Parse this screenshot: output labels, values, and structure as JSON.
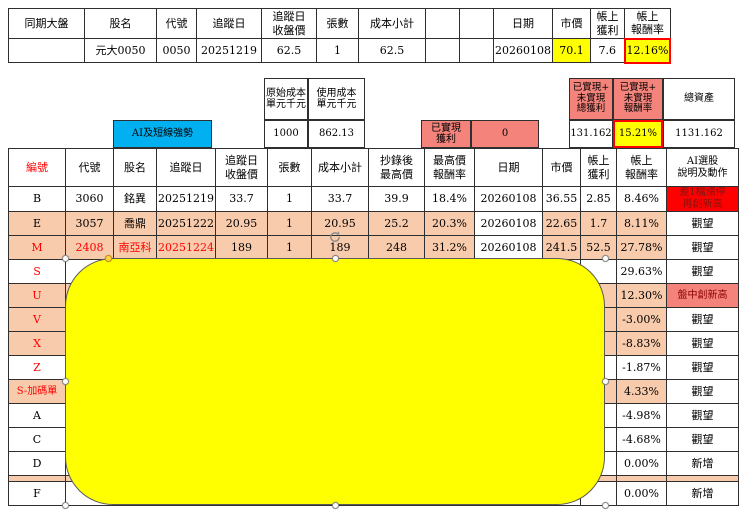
{
  "colors": {
    "yellow": "#FFFF00",
    "salmon": "#F4837C",
    "peach": "#F8CBAD",
    "blue": "#00B0F0",
    "red": "#FF0000",
    "red_cell_text": "#7C1712",
    "salmon_cell_text": "#8B0000",
    "highlight_border": "#FF0000"
  },
  "top_table": {
    "headers": [
      "同期大盤",
      "股名",
      "代號",
      "追蹤日",
      "追蹤日\n收盤價",
      "張數",
      "成本小計",
      "",
      "",
      "日期",
      "市價",
      "帳上\n獲利",
      "帳上\n報酬率"
    ],
    "values": [
      "",
      "元大0050",
      "0050",
      "20251219",
      "62.5",
      "1",
      "62.5",
      "",
      "",
      "20260108",
      "70.1",
      "7.6",
      "12.16%"
    ]
  },
  "summary": {
    "ai_tag": "AI及短線強勢",
    "original_cost_label": "原始成本\n單元千元",
    "original_cost": "1000",
    "used_cost_label": "使用成本\n單元千元",
    "used_cost": "862.13",
    "realized_label": "已實現\n獲利",
    "realized_value": "0",
    "total_profit_label": "已實現+\n未實現\n總獲利",
    "total_profit": "131.162",
    "total_return_label": "已實現+\n未實現\n報酬率",
    "total_return": "15.21%",
    "total_assets_label": "總資產",
    "total_assets": "1131.162"
  },
  "main_table": {
    "headers": [
      "編號",
      "代號",
      "股名",
      "追蹤日",
      "追蹤日\n收盤價",
      "張數",
      "成本小計",
      "抄錄後\n最高價",
      "最高價\n報酬率",
      "日期",
      "市價",
      "帳上\n獲利",
      "帳上\n報酬率",
      "AI選股\n說明及動作"
    ],
    "rows": [
      {
        "id": "B",
        "code": "3060",
        "name": "銘異",
        "track_date": "20251219",
        "track_close": "33.7",
        "lots": "1",
        "cost": "33.7",
        "high": "39.9",
        "high_return": "18.4%",
        "date": "20260108",
        "price": "36.55",
        "profit": "2.85",
        "return_pct": "8.46%",
        "action": "差1檔漲停\n再創新高",
        "bg": "white",
        "id_red": false,
        "label_red": false,
        "action_bg": "red"
      },
      {
        "id": "E",
        "code": "3057",
        "name": "喬鼎",
        "track_date": "20251222",
        "track_close": "20.95",
        "lots": "1",
        "cost": "20.95",
        "high": "25.2",
        "high_return": "20.3%",
        "date": "20260108",
        "price": "22.65",
        "profit": "1.7",
        "return_pct": "8.11%",
        "action": "觀望",
        "bg": "peach",
        "id_red": false,
        "label_red": false,
        "action_bg": "white"
      },
      {
        "id": "M",
        "code": "2408",
        "name": "南亞科",
        "track_date": "20251224",
        "track_close": "189",
        "lots": "1",
        "cost": "189",
        "high": "248",
        "high_return": "31.2%",
        "date": "20260108",
        "price": "241.5",
        "profit": "52.5",
        "return_pct": "27.78%",
        "action": "觀望",
        "bg": "peach",
        "id_red": true,
        "label_red": true,
        "action_bg": "white"
      },
      {
        "id": "S",
        "code": "",
        "name": "",
        "track_date": "",
        "track_close": "",
        "lots": "",
        "cost": "",
        "high": "",
        "high_return": "",
        "date": "",
        "price": "",
        "profit": "",
        "return_pct": "29.63%",
        "action": "觀望",
        "bg": "white",
        "id_red": true,
        "label_red": false,
        "action_bg": "white"
      },
      {
        "id": "U",
        "code": "",
        "name": "",
        "track_date": "",
        "track_close": "",
        "lots": "",
        "cost": "",
        "high": "",
        "high_return": "",
        "date": "",
        "price": "",
        "profit": "",
        "return_pct": "12.30%",
        "action": "盤中創新高",
        "bg": "peach",
        "id_red": true,
        "label_red": false,
        "action_bg": "salmon"
      },
      {
        "id": "V",
        "code": "",
        "name": "",
        "track_date": "",
        "track_close": "",
        "lots": "",
        "cost": "",
        "high": "",
        "high_return": "",
        "date": "",
        "price": "",
        "profit": "",
        "return_pct": "-3.00%",
        "action": "觀望",
        "bg": "peach",
        "id_red": true,
        "label_red": false,
        "action_bg": "white"
      },
      {
        "id": "X",
        "code": "",
        "name": "",
        "track_date": "",
        "track_close": "",
        "lots": "",
        "cost": "",
        "high": "",
        "high_return": "",
        "date": "",
        "price": "",
        "profit": "",
        "return_pct": "-8.83%",
        "action": "觀望",
        "bg": "peach",
        "id_red": true,
        "label_red": false,
        "action_bg": "white"
      },
      {
        "id": "Z",
        "code": "",
        "name": "",
        "track_date": "",
        "track_close": "",
        "lots": "",
        "cost": "",
        "high": "",
        "high_return": "",
        "date": "",
        "price": "",
        "profit": "",
        "return_pct": "-1.87%",
        "action": "觀望",
        "bg": "white",
        "id_red": true,
        "label_red": false,
        "action_bg": "white"
      },
      {
        "id": "S-加碼單",
        "code": "",
        "name": "",
        "track_date": "",
        "track_close": "",
        "lots": "",
        "cost": "",
        "high": "",
        "high_return": "",
        "date": "",
        "price": "",
        "profit": "",
        "return_pct": "4.33%",
        "action": "觀望",
        "bg": "peach",
        "id_red": true,
        "label_red": false,
        "action_bg": "white"
      },
      {
        "id": "A",
        "code": "",
        "name": "",
        "track_date": "",
        "track_close": "",
        "lots": "",
        "cost": "",
        "high": "",
        "high_return": "",
        "date": "",
        "price": "",
        "profit": "",
        "return_pct": "-4.98%",
        "action": "觀望",
        "bg": "white",
        "id_red": false,
        "label_red": false,
        "action_bg": "white"
      },
      {
        "id": "C",
        "code": "",
        "name": "",
        "track_date": "",
        "track_close": "",
        "lots": "",
        "cost": "",
        "high": "",
        "high_return": "",
        "date": "",
        "price": "",
        "profit": "",
        "return_pct": "-4.68%",
        "action": "觀望",
        "bg": "white",
        "id_red": false,
        "label_red": false,
        "action_bg": "white"
      },
      {
        "id": "D",
        "code": "",
        "name": "",
        "track_date": "",
        "track_close": "",
        "lots": "",
        "cost": "",
        "high": "",
        "high_return": "",
        "date": "",
        "price": "",
        "profit": "",
        "return_pct": "0.00%",
        "action": "新增",
        "bg": "white",
        "id_red": false,
        "label_red": false,
        "action_bg": "white"
      },
      {
        "id": "",
        "code": "",
        "name": "",
        "track_date": "",
        "track_close": "",
        "lots": "",
        "cost": "",
        "high": "",
        "high_return": "",
        "date": "",
        "price": "",
        "profit": "",
        "return_pct": "",
        "action": "",
        "bg": "peach",
        "id_red": false,
        "label_red": false,
        "action_bg": "peach",
        "height": 6
      },
      {
        "id": "F",
        "code": "",
        "name": "",
        "track_date": "",
        "track_close": "",
        "lots": "",
        "cost": "",
        "high": "",
        "high_return": "",
        "date": "",
        "price": "",
        "profit": "",
        "return_pct": "0.00%",
        "action": "新增",
        "bg": "white",
        "id_red": false,
        "label_red": false,
        "action_bg": "white"
      }
    ]
  },
  "shape": {
    "type": "rounded-rectangle",
    "fill": "#FFFF00"
  }
}
